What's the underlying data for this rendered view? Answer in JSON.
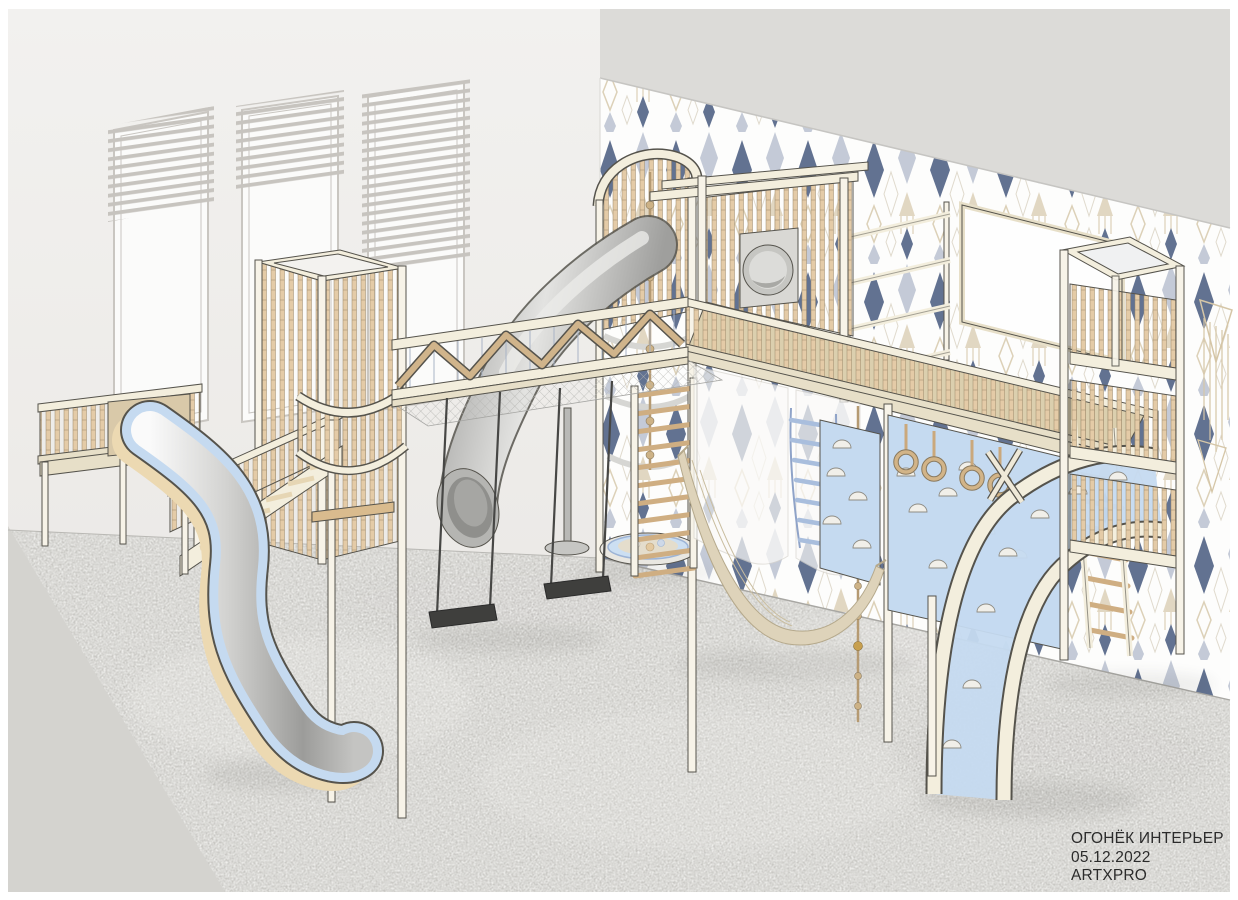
{
  "title_block": {
    "project_name": "ОГОНЁК ИНТЕРЬЕР",
    "date": "05.12.2022",
    "author": "ARTXPRO"
  },
  "theme": {
    "page_bg": "#ffffff",
    "wall_left": "#f2f1ef",
    "wall_left_low": "#eceae7",
    "backdrop": "#dcdbd8",
    "wallpaper_bg": "#fdfdfc",
    "navy": "#3e5178",
    "grayblue": "#b7bfce",
    "beige": "#d5c6a7",
    "carpet": "#c8c7c3",
    "floor_smooth": "#d4d3cf",
    "cream": "#f3eedd",
    "cream_dark": "#e7dfc8",
    "post": "#f7f3e8",
    "outline": "#55534c",
    "slat": "#e4cba7",
    "slat_dark": "#cfae82",
    "deck": "#dbcfae",
    "blue": "#c5daf0",
    "blue_dark": "#a9bedd",
    "tube": "#c7c7c5",
    "rope": "#c1a87e",
    "swing": "#474745",
    "hammock": "#ded3ba",
    "glass": "#fbfbfa",
    "frame": "#c9c6c1",
    "blind": "#c7c4bf",
    "gold": "#c79f4e",
    "whiteboard": "#fefefe",
    "text": "#2b2b2b"
  },
  "scene": {
    "type": "children playroom interior render",
    "windows_count": 3,
    "swings_count": 2,
    "gym_rings_count": 4,
    "equipment": [
      "far-left-platform",
      "wave-slide",
      "left-tower",
      "curved-balcony",
      "staircase",
      "rope-bridge-with-net",
      "swing",
      "swing",
      "spiral-tube-slide",
      "round-tower",
      "climbing-rope",
      "ball-pit",
      "swedish-wall-ladder",
      "upper-deck",
      "porthole-entry",
      "wall-bars",
      "whiteboard",
      "sheer-curtains",
      "rope-ladder",
      "knotted-bead-rope",
      "climbing-wall",
      "gym-rings",
      "hammock",
      "arch-climber",
      "wooden-ladder",
      "right-tower",
      "macrame-hangings",
      "window-blinds",
      "diamond-wallpaper",
      "gray-carpet"
    ]
  }
}
